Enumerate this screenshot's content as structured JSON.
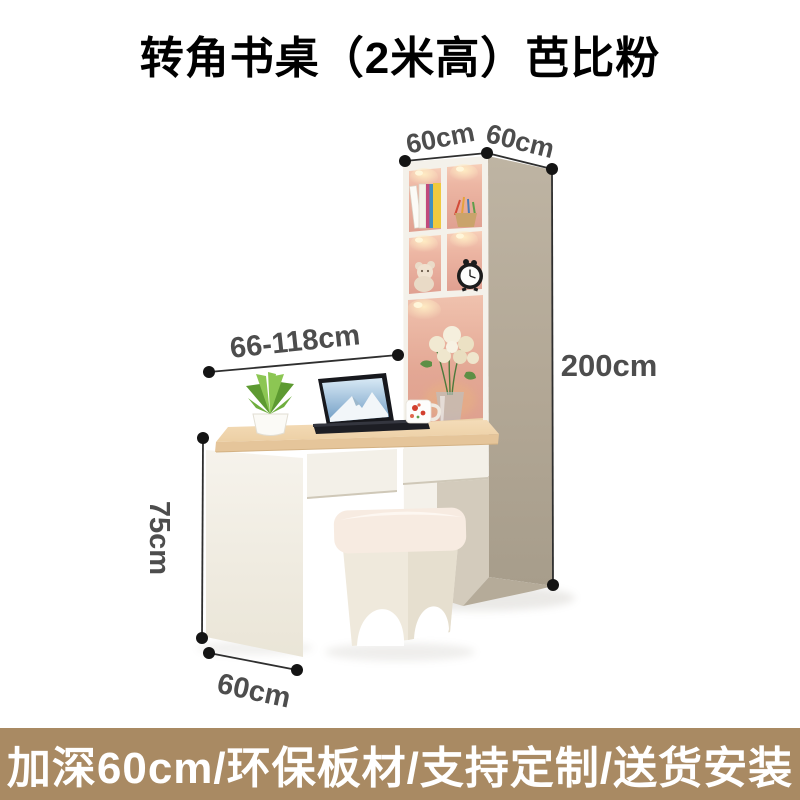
{
  "title": "转角书桌（2米高）芭比粉",
  "dimensions": {
    "cabinet_width": "60cm",
    "cabinet_depth": "60cm",
    "total_height": "200cm",
    "desk_length_range": "66-118cm",
    "desk_height": "75cm",
    "desk_depth": "60cm"
  },
  "banner": {
    "text": "加深60cm/环保板材/支持定制/送货安装"
  },
  "colors": {
    "banner_bg": "#a98a63",
    "banner_text": "#ffffff",
    "accent_pink": "#e7ad9c",
    "cabinet_side_tan": "#b3a897",
    "desk_wood": "#f0d5ae",
    "panel_cream": "#f4f1ea",
    "dimension_text": "#4d4d4d",
    "dimension_line": "#2f2f2f",
    "title_text": "#000000"
  }
}
